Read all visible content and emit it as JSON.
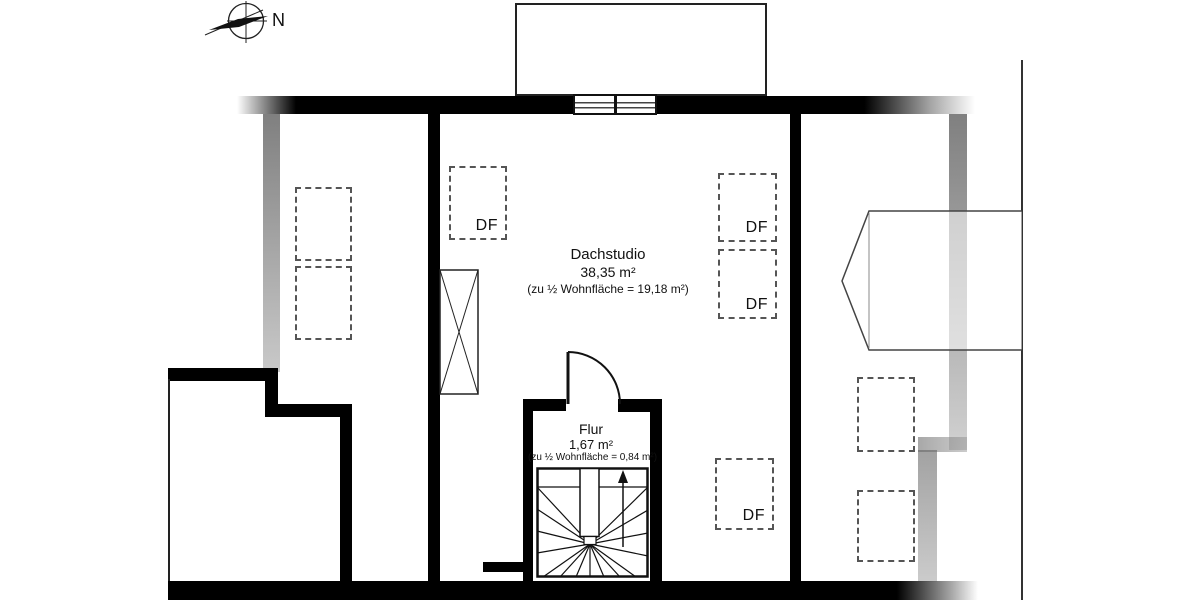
{
  "compass": {
    "label": "N"
  },
  "rooms": {
    "dachstudio": {
      "name": "Dachstudio",
      "area": "38,35 m²",
      "note": "(zu ½ Wohnfläche = 19,18 m²)"
    },
    "flur": {
      "name": "Flur",
      "area": "1,67 m²",
      "note": "(zu ½ Wohnfläche = 0,84 m²)"
    }
  },
  "skylights": {
    "labels": [
      "DF",
      "DF",
      "DF",
      "DF"
    ]
  },
  "colors": {
    "wall": "#000000",
    "hatch_line": "#222222",
    "knee_wall_gray": "#787878",
    "dashed_border": "#555555"
  }
}
